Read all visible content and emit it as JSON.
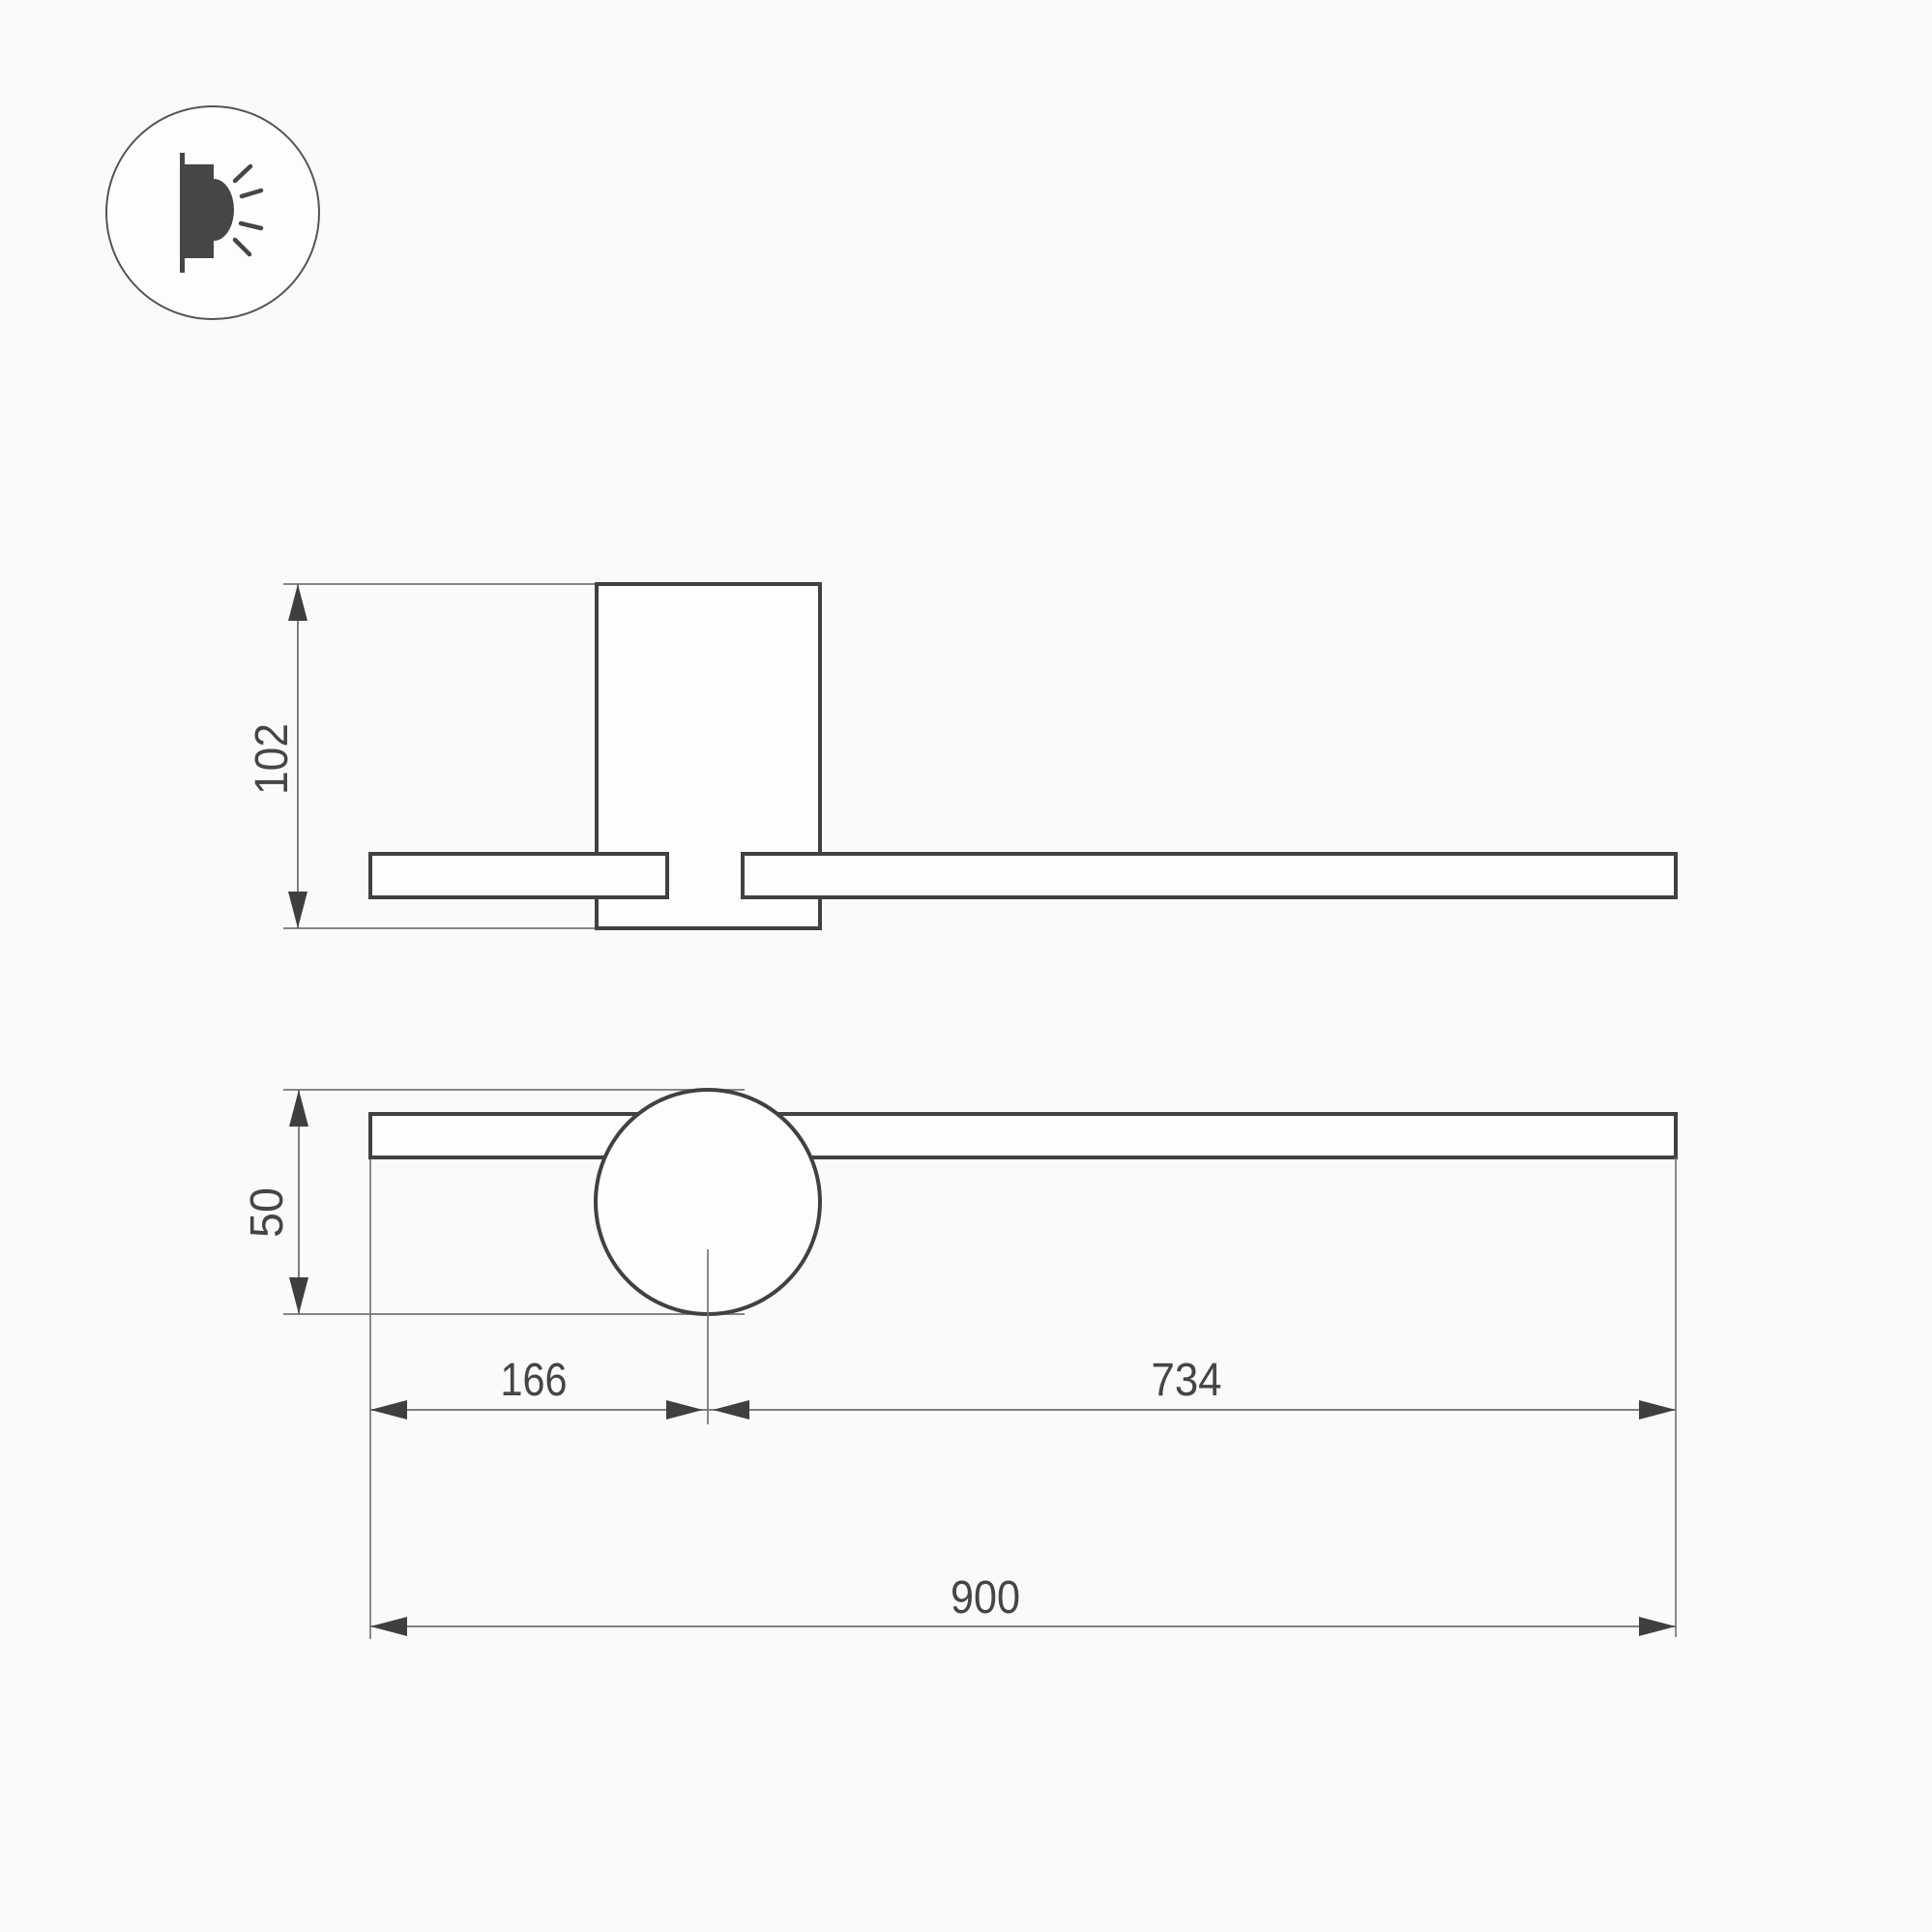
{
  "colors": {
    "background": "#fafafa",
    "shape_fill": "#fdfdfd",
    "outline": "#414141",
    "thin_line": "#757575",
    "arrow": "#3f3f41",
    "label_text": "#454545",
    "icon": "#464646"
  },
  "icons": {
    "wall_light": "wall-mounted-light-emission-icon"
  },
  "drawing": {
    "side_view": {
      "height_label": "102"
    },
    "front_view": {
      "lamp_height_label": "50",
      "left_offset_label": "166",
      "right_span_label": "734",
      "overall_length_label": "900"
    }
  }
}
